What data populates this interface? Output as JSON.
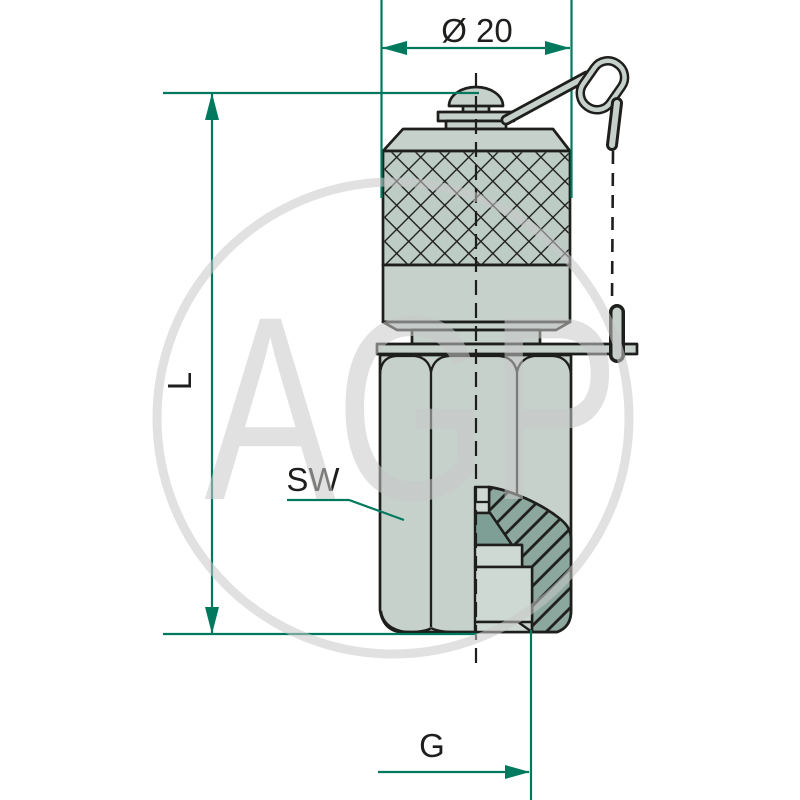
{
  "labels": {
    "diameter": "Ø 20",
    "length": "L",
    "wrench_size": "SW",
    "thread": "G"
  },
  "watermark": {
    "text": "AGP"
  },
  "colors": {
    "dimension": "#00795e",
    "ink": "#1e1e1c",
    "body": "#c6d1cc",
    "body_light": "#cfd9d3",
    "knurl_fill": "#bdccc5",
    "cut": "#8ca79e",
    "cone": "#7e9f95",
    "watermark": "#c9c9c9",
    "bg": "#ffffff"
  }
}
